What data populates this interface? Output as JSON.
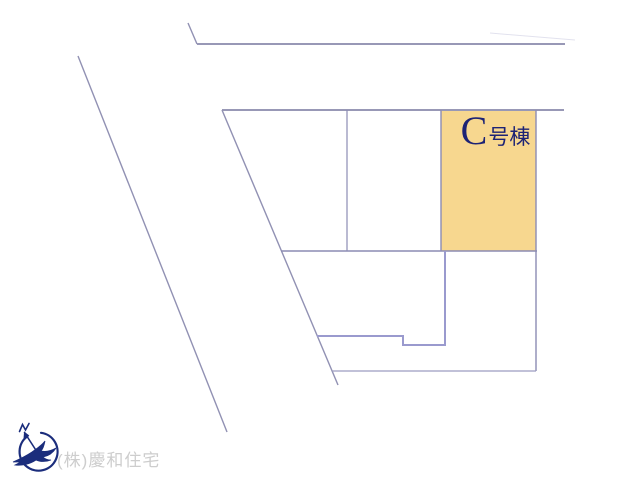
{
  "plan": {
    "background": "#ffffff",
    "road_line_color": "#9191b3",
    "plot_line_color": "#8c8cb4",
    "step_line_color": "#9a9ace",
    "faint_line_color": "#e2e2ee",
    "lines": [
      {
        "type": "line",
        "x1": 78,
        "y1": 56,
        "x2": 227,
        "y2": 432,
        "color": "#9191b3",
        "w": 1.4,
        "name": "road-edge-left-outer"
      },
      {
        "type": "line",
        "x1": 188,
        "y1": 23,
        "x2": 197,
        "y2": 44,
        "color": "#9191b3",
        "w": 1.4,
        "name": "road-edge-top-bend"
      },
      {
        "type": "line",
        "x1": 197,
        "y1": 44,
        "x2": 565,
        "y2": 44,
        "color": "#9898b6",
        "w": 2,
        "name": "road-edge-top"
      },
      {
        "type": "line",
        "x1": 490,
        "y1": 33,
        "x2": 575,
        "y2": 40,
        "color": "#e2e2ee",
        "w": 1,
        "name": "faint-boundary"
      },
      {
        "type": "line",
        "x1": 222,
        "y1": 110,
        "x2": 564,
        "y2": 110,
        "color": "#9898b6",
        "w": 2,
        "name": "block-top-boundary"
      },
      {
        "type": "line",
        "x1": 222,
        "y1": 110,
        "x2": 338,
        "y2": 385,
        "color": "#9191b3",
        "w": 1.4,
        "name": "road-edge-left-inner"
      },
      {
        "type": "line",
        "x1": 347,
        "y1": 110,
        "x2": 347,
        "y2": 251,
        "color": "#8c8cb4",
        "w": 1.2,
        "name": "plot-divider-1"
      },
      {
        "type": "line",
        "x1": 441,
        "y1": 110,
        "x2": 441,
        "y2": 251,
        "color": "#8c8cb4",
        "w": 1.4,
        "name": "lot-c-left-boundary"
      },
      {
        "type": "line",
        "x1": 536,
        "y1": 110,
        "x2": 536,
        "y2": 371,
        "color": "#8c8cb4",
        "w": 1.4,
        "name": "block-right-boundary"
      },
      {
        "type": "line",
        "x1": 281,
        "y1": 251,
        "x2": 537,
        "y2": 251,
        "color": "#8c8cb4",
        "w": 1.4,
        "name": "plot-row-bottom-boundary"
      },
      {
        "type": "polyline",
        "points": "445,251 445,345 403,345 403,336 317,336",
        "color": "#9a9ace",
        "w": 2,
        "name": "lower-plot-step-boundary"
      },
      {
        "type": "line",
        "x1": 332,
        "y1": 371,
        "x2": 536,
        "y2": 371,
        "color": "#9c9cc0",
        "w": 1.2,
        "name": "block-bottom-boundary"
      }
    ],
    "lot": {
      "x": 441,
      "y": 111,
      "w": 95,
      "h": 140,
      "fill": "#f7d78f",
      "label_main": "C",
      "label_suffix": "号棟",
      "label_color": "#1d2375"
    }
  },
  "footer": {
    "company": "(株)慶和住宅",
    "text_color": "#cdcdcd"
  },
  "compass": {
    "color": "#1b2d7c"
  }
}
